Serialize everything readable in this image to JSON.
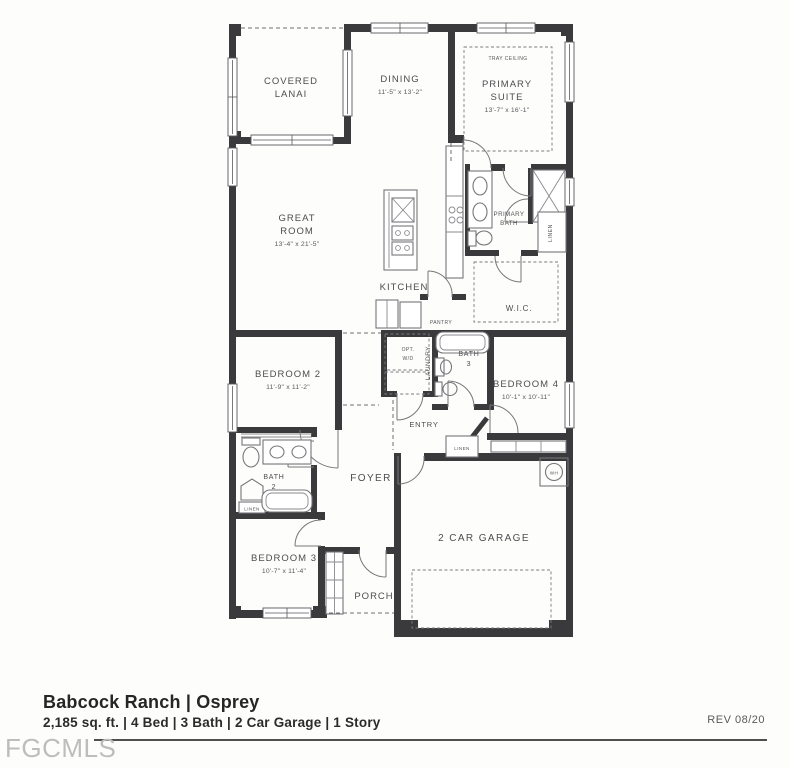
{
  "floor_plan": {
    "rooms": {
      "covered_lanai": {
        "name_lines": [
          "COVERED",
          "LANAI"
        ]
      },
      "dining": {
        "name": "DINING",
        "dims": "11'-5\" x 13'-2\""
      },
      "primary_suite": {
        "name_lines": [
          "PRIMARY",
          "SUITE"
        ],
        "dims": "13'-7\" x 16'-1\"",
        "feature": "TRAY CEILING"
      },
      "great_room": {
        "name_lines": [
          "GREAT",
          "ROOM"
        ],
        "dims": "13'-4\" x 21'-5\""
      },
      "kitchen": {
        "name": "KITCHEN"
      },
      "pantry": {
        "name": "PANTRY"
      },
      "primary_bath": {
        "name_lines": [
          "PRIMARY",
          "BATH"
        ]
      },
      "wic": {
        "name": "W.I.C."
      },
      "laundry": {
        "name": "LAUNDRY",
        "option_lines": [
          "OPT.",
          "W/D"
        ]
      },
      "bath_3": {
        "name_lines": [
          "BATH",
          "3"
        ]
      },
      "bedroom_2": {
        "name": "BEDROOM 2",
        "dims": "11'-9\" x 11'-2\""
      },
      "bedroom_3": {
        "name": "BEDROOM 3",
        "dims": "10'-7\" x 11'-4\""
      },
      "bedroom_4": {
        "name": "BEDROOM 4",
        "dims": "10'-1\" x 10'-11\""
      },
      "bath_2": {
        "name_lines": [
          "BATH",
          "2"
        ]
      },
      "entry": {
        "name": "ENTRY"
      },
      "foyer": {
        "name": "FOYER"
      },
      "porch": {
        "name": "PORCH"
      },
      "garage": {
        "name": "2 CAR GARAGE"
      }
    },
    "labels": {
      "linen": "LINEN",
      "water_heater": "WH"
    }
  },
  "footer": {
    "title": "Babcock Ranch | Osprey",
    "specs": "2,185 sq. ft. | 4 Bed | 3 Bath | 2 Car Garage | 1 Story",
    "revision": "REV 08/20",
    "watermark": "FGCMLS"
  },
  "colors": {
    "wall": "#3a3a3c",
    "label_text": "#4d4d50",
    "footer_text": "#262626",
    "watermark": "#bdbdbd"
  }
}
